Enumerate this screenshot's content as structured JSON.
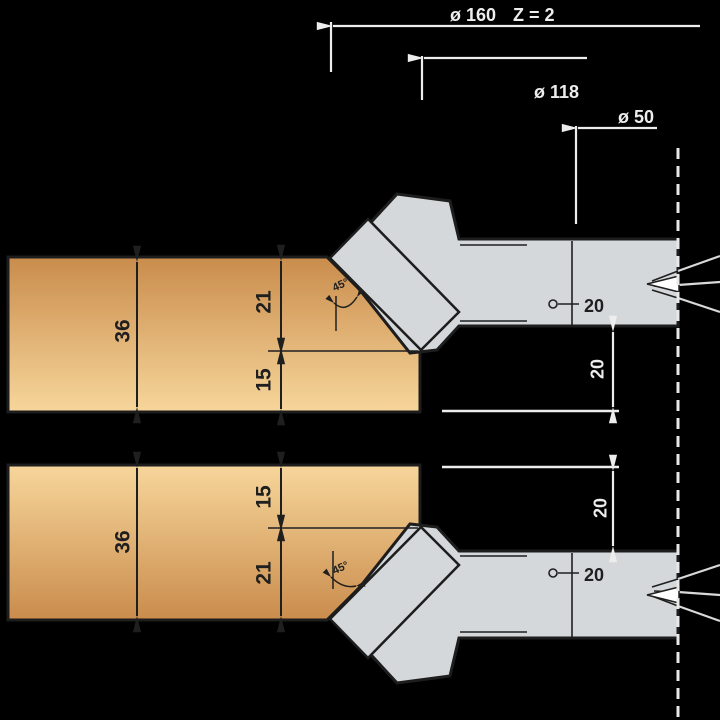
{
  "colors": {
    "background": "#000000",
    "wood_dark": "#c98c4c",
    "wood_light": "#f7d69b",
    "steel": "#d4d8da",
    "outline": "#1d1d1d",
    "dim_dark": "#1f1f1f",
    "dim_light": "#ededed",
    "wedge_fill": "#ffffff"
  },
  "header_dims": {
    "outer_diameter": "ø 160",
    "teeth_count": "Z = 2",
    "body_diameter": "ø 118",
    "bore_diameter": "ø 50"
  },
  "top_assembly": {
    "board_thickness": "36",
    "chamfer_depth": "21",
    "remaining_edge": "15",
    "chamfer_angle": "45°",
    "hub_width": "20",
    "hub_offset": "20"
  },
  "bottom_assembly": {
    "board_thickness": "36",
    "remaining_edge": "15",
    "chamfer_depth": "21",
    "chamfer_angle": "45°",
    "hub_width": "20",
    "hub_offset": "20"
  }
}
